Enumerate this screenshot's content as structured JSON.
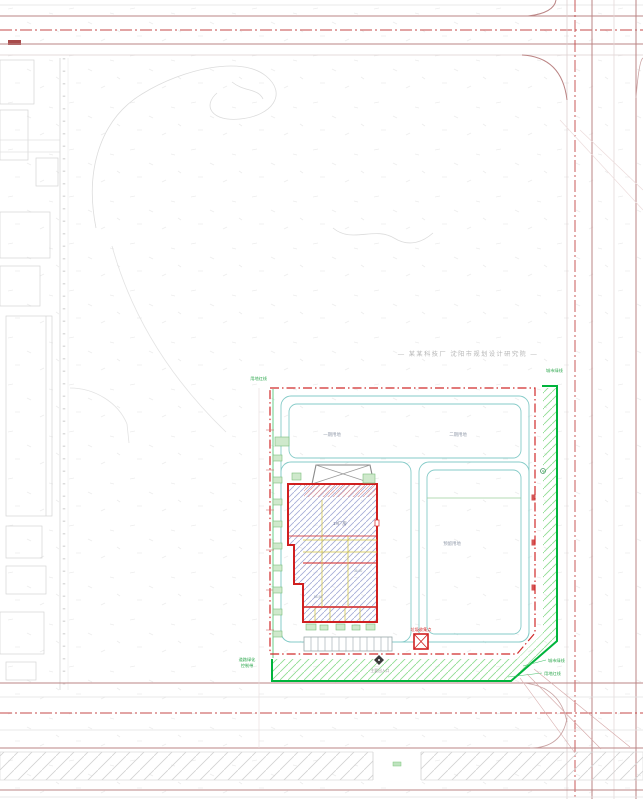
{
  "drawing": {
    "title_annotation": "— 某某科技厂 沈阳市规划设计研究院 —",
    "site": {
      "red_line_label": "用地红线",
      "green_line_label": "城市绿线",
      "parcels": {
        "a": "一期用地",
        "b": "二期用地",
        "c": "预留用地"
      },
      "green_belt": {
        "line1": "道路绿化",
        "line2": "控制带"
      },
      "leaders": {
        "green": "城市绿线",
        "red": "用地红线"
      }
    },
    "building": {
      "name": "1#厂房",
      "dim_a": "36.00",
      "dim_b": "58.50"
    },
    "waste_label": "垃圾收集点",
    "entrance_label": "主要出入口",
    "colors": {
      "site_boundary_red": "#d02a2a",
      "building_red": "#d01f1f",
      "green_belt": "#00b43c",
      "internal_road_teal": "#85cbc8",
      "road_centerline": "#c54848",
      "annotation_gray": "#b5b5b5",
      "label_green": "#2fa84f"
    }
  }
}
